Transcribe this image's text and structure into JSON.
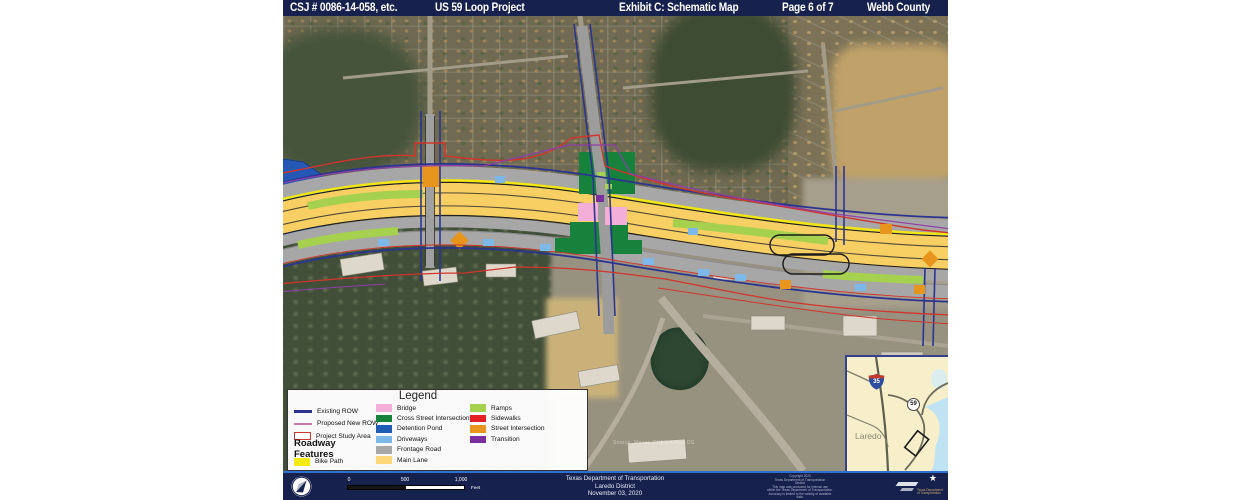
{
  "header": {
    "csj": "CSJ # 0086-14-058, etc.",
    "project": "US 59 Loop Project",
    "exhibit": "Exhibit C: Schematic Map",
    "page": "Page 6 of 7",
    "county": "Webb County"
  },
  "legend": {
    "title": "Legend",
    "left_items": [
      {
        "label": "Existing ROW",
        "color": "#2b3590"
      },
      {
        "label": "Proposed New ROW",
        "color": "#c57aa8"
      },
      {
        "label": "Project Study Area",
        "color": "#cc3b33"
      }
    ],
    "roadway_heading": "Roadway Features",
    "roadway_items": [
      {
        "label": "Bike Path",
        "color": "#f5ea14"
      }
    ],
    "mid_items": [
      {
        "label": "Bridge",
        "color": "#f4aeda"
      },
      {
        "label": "Cross Street Intersections",
        "color": "#17823c"
      },
      {
        "label": "Detention Pond",
        "color": "#1f5cb4"
      },
      {
        "label": "Driveways",
        "color": "#7cb9e8"
      },
      {
        "label": "Frontage Road",
        "color": "#a7a7a7"
      },
      {
        "label": "Main Lane",
        "color": "#fcd87a"
      }
    ],
    "right_items": [
      {
        "label": "Ramps",
        "color": "#a5d14f"
      },
      {
        "label": "Sidewalks",
        "color": "#e31f26"
      },
      {
        "label": "Street Intersection",
        "color": "#e8951e"
      },
      {
        "label": "Transition",
        "color": "#7a2f9e"
      }
    ]
  },
  "inset": {
    "city": "Laredo",
    "interstate_shield": "35",
    "us_shield": "59"
  },
  "map": {
    "attribution": "Source: Maxar, CNES/Airbus DS"
  },
  "footer": {
    "agency": "Texas Department of Transportation",
    "district": "Laredo District",
    "date": "November 03, 2020",
    "scale": {
      "start": "0",
      "mid": "500",
      "end": "1,000",
      "unit": "Feet"
    },
    "copyright_lines": [
      "Copyright 2020",
      "Texas Department of Transportation",
      "District",
      "This map was produced for internal use",
      "within the Texas Department of Transportation.",
      "Accuracy is limited to the validity of available",
      "data."
    ],
    "logo_caption": "Texas Department of Transportation"
  },
  "colors": {
    "header_bg": "#16214d",
    "main_lane": "#f7cf63",
    "bike_path": "#f2e713",
    "frontage": "#a7a7a7",
    "ramps": "#a5d14f",
    "cross_street": "#17823c",
    "bridge": "#f4aeda",
    "detention_pond": "#2458b4",
    "driveways": "#7cb9e8",
    "street_intersection": "#e8951e",
    "existing_row": "#2b3590",
    "study_area": "#d2342b",
    "proposed_row": "#8f3fa8"
  }
}
